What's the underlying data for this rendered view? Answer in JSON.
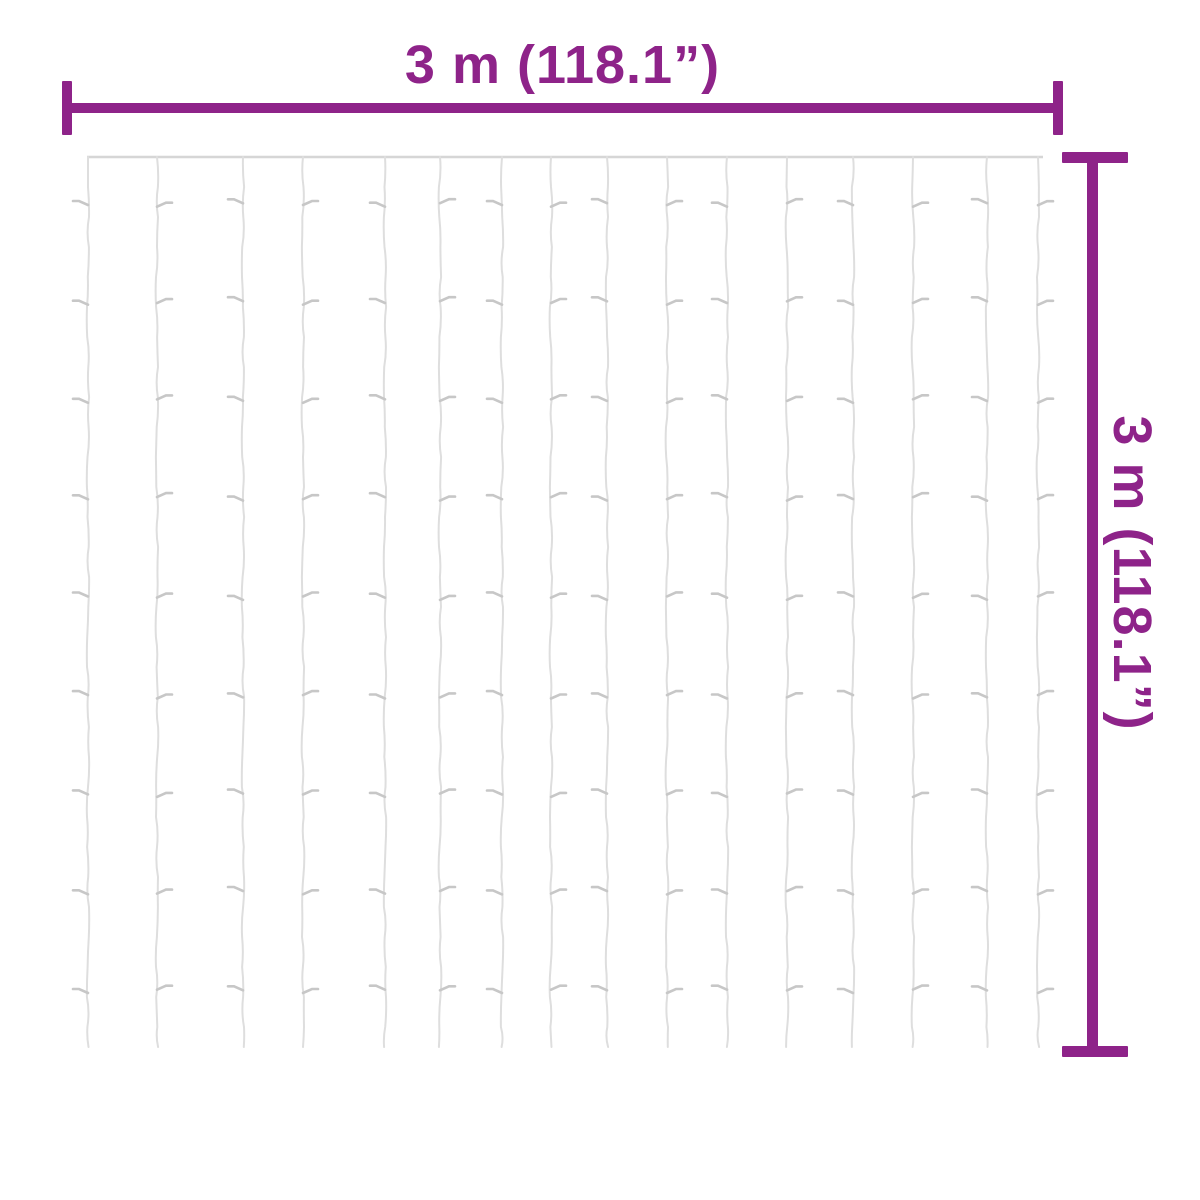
{
  "labels": {
    "width": "3 m (118.1”)",
    "height": "3 m (118.1”)"
  },
  "colors": {
    "background": "#ffffff",
    "dimension": "#8E2389",
    "wire": "#d6d6d6",
    "strand": "#dedede",
    "bulb": "#c7c7c7"
  },
  "curtain": {
    "wire_y": 157,
    "wire_x1": 87,
    "wire_x2": 1043,
    "strand_bottom": 1047,
    "strand_x": [
      88,
      157,
      243,
      303,
      385,
      440,
      502,
      551,
      607,
      667,
      727,
      787,
      853,
      913,
      987,
      1038
    ],
    "bulb_rows_y": [
      205,
      303,
      401,
      499,
      598,
      697,
      795,
      893,
      991
    ],
    "strand_count": 16,
    "bulbs_per_strand": 9
  }
}
